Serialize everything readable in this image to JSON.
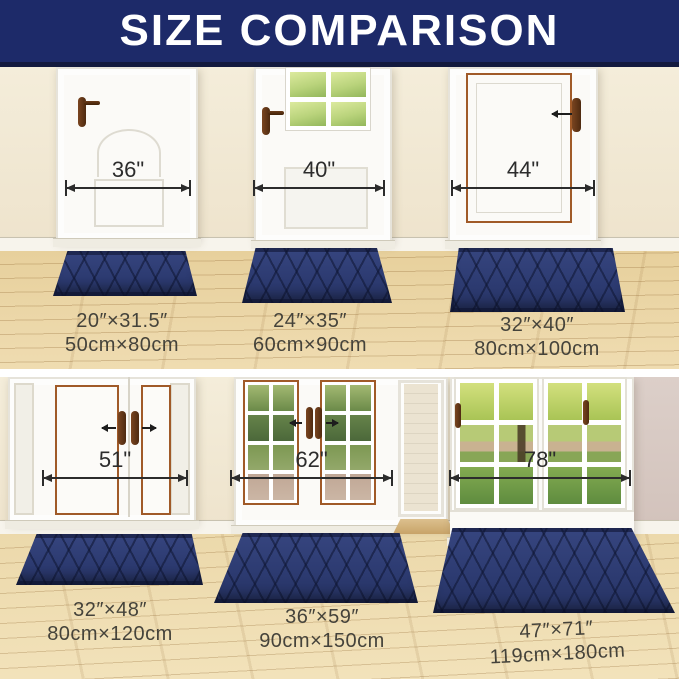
{
  "title": "SIZE COMPARISON",
  "colors": {
    "banner_navy": "#1d2a69",
    "mat_navy": "#2c3a70",
    "wall_cream": "#f2ead8",
    "wall_pink": "#d7c8c2",
    "floor_wood": "#e9d2a0",
    "copper_trim": "#a05a28",
    "measure_line": "#2c2c2c"
  },
  "icons": {
    "arrowhead_left": "css-triangle",
    "arrowhead_right": "css-triangle",
    "extent_tick": "css-bar"
  },
  "panels": [
    {
      "door_width_label": "36\"",
      "mat_size_in": "20″×31.5″",
      "mat_size_cm": "50cm×80cm"
    },
    {
      "door_width_label": "40\"",
      "mat_size_in": "24″×35″",
      "mat_size_cm": "60cm×90cm"
    },
    {
      "door_width_label": "44\"",
      "mat_size_in": "32″×40″",
      "mat_size_cm": "80cm×100cm"
    },
    {
      "door_width_label": "51\"",
      "mat_size_in": "32″×48″",
      "mat_size_cm": "80cm×120cm"
    },
    {
      "door_width_label": "62\"",
      "mat_size_in": "36″×59″",
      "mat_size_cm": "90cm×150cm"
    },
    {
      "door_width_label": "78\"",
      "mat_size_in": "47″×71″",
      "mat_size_cm": "119cm×180cm"
    }
  ]
}
